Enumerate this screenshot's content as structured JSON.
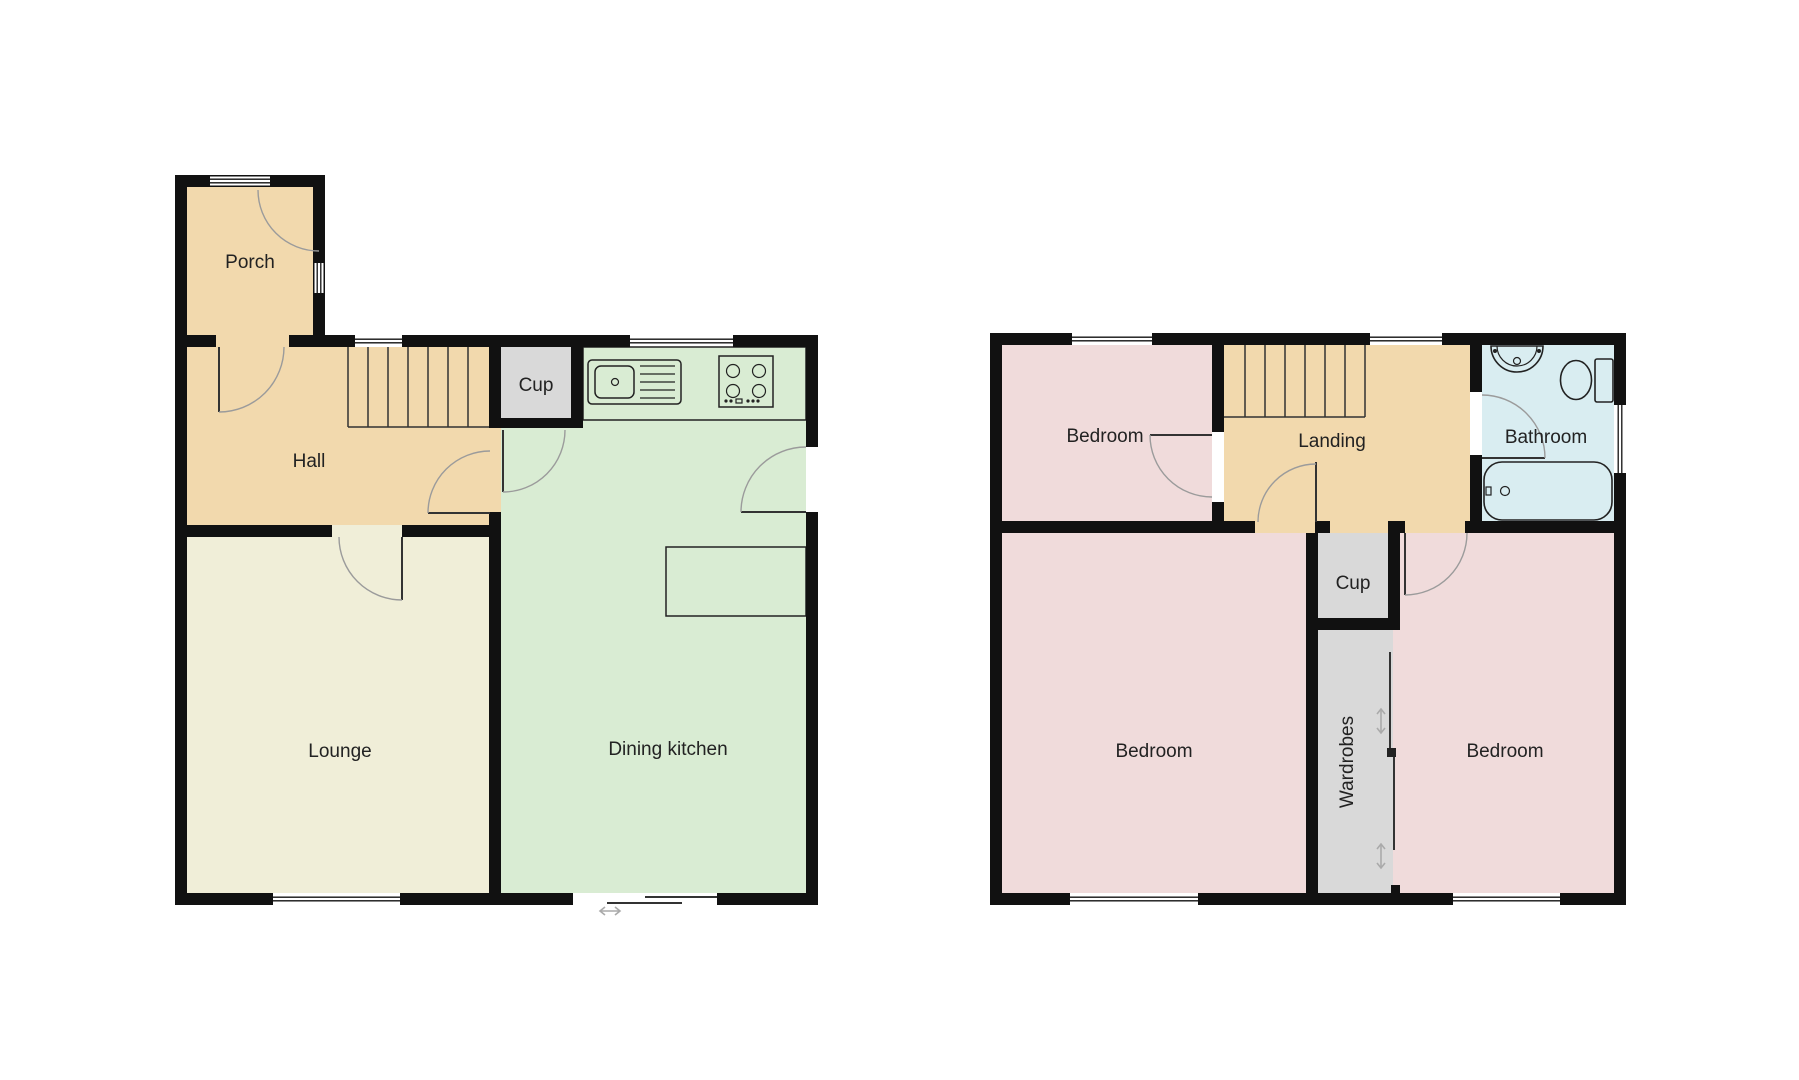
{
  "floorplan": {
    "colors": {
      "bg": "#ffffff",
      "wall": "#111111",
      "tan": "#f2d9ad",
      "pink": "#f0dbdb",
      "cream": "#f0eed8",
      "green": "#d9ecd3",
      "blue": "#d9edf1",
      "gray": "#d9d9d9",
      "arc": "#9b9b9b",
      "line": "#333333",
      "fixture": "#222222",
      "arrow": "#aaaaaa"
    },
    "ground": {
      "rooms": [
        {
          "name": "Porch",
          "color_key": "tan"
        },
        {
          "name": "Hall",
          "color_key": "tan"
        },
        {
          "name": "Cup",
          "color_key": "gray"
        },
        {
          "name": "Lounge",
          "color_key": "cream"
        },
        {
          "name": "Dining kitchen",
          "color_key": "green"
        }
      ],
      "fixtures": [
        "staircase",
        "kitchen-sink",
        "hob",
        "kitchen-counter",
        "table",
        "sliding-patio-door"
      ]
    },
    "first": {
      "rooms": [
        {
          "name": "Bedroom",
          "color_key": "pink"
        },
        {
          "name": "Landing",
          "color_key": "tan"
        },
        {
          "name": "Bathroom",
          "color_key": "blue"
        },
        {
          "name": "Cup",
          "color_key": "gray"
        },
        {
          "name": "Wardrobes",
          "color_key": "gray"
        },
        {
          "name": "Bedroom",
          "color_key": "pink"
        },
        {
          "name": "Bedroom",
          "color_key": "pink"
        }
      ],
      "fixtures": [
        "staircase",
        "wash-basin",
        "toilet",
        "bathtub",
        "wardrobe-sliding-doors"
      ]
    }
  }
}
